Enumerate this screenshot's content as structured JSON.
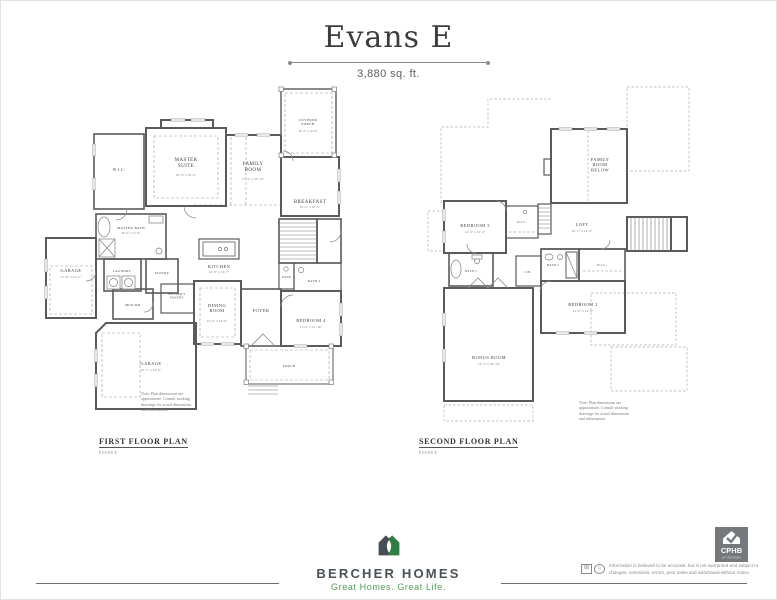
{
  "header": {
    "title": "Evans E",
    "subtitle": "3,880 sq. ft."
  },
  "first_floor": {
    "caption": "FIRST FLOOR PLAN",
    "caption_sub": "EVANS E",
    "note": "Note: Plan dimensions are approximate. Consult working drawings for actual dimensions and information.",
    "rooms": {
      "wic": {
        "name": "W.I.C."
      },
      "master_suite": {
        "name": "MASTER SUITE",
        "dims": "16'-4\" x 16'-0\""
      },
      "family_room": {
        "name": "FAMILY ROOM",
        "dims": "17'-4\" x 16'-10\""
      },
      "covered_porch": {
        "name": "COVERED PORCH",
        "dims": "16'-2\" x 10'-0\""
      },
      "breakfast": {
        "name": "BREAKFAST",
        "dims": "10'-2\" x 10'-0\""
      },
      "master_bath": {
        "name": "MASTER BATH",
        "dims": "16'-0\" x 12'-6\""
      },
      "garage_side": {
        "name": "GARAGE",
        "dims": "21'-8\" x 21'-2\""
      },
      "laundry": {
        "name": "LAUNDRY"
      },
      "pantry": {
        "name": "PANTRY"
      },
      "mud_rm": {
        "name": "MUD RM"
      },
      "butlers_pantry": {
        "name": "BUTLER'S PANTRY"
      },
      "kitchen": {
        "name": "KITCHEN",
        "dims": "12'-8\" x 13'-7\""
      },
      "dining_room": {
        "name": "DINING ROOM",
        "dims": "12'-0\" x 13'-0\""
      },
      "foyer": {
        "name": "FOYER"
      },
      "pwdr": {
        "name": "PWDR"
      },
      "bath4": {
        "name": "BATH 4"
      },
      "bedroom4": {
        "name": "BEDROOM 4",
        "dims": "11'-4\" x 12'-10\""
      },
      "garage_rear": {
        "name": "GARAGE",
        "dims": "22'-7\" x 24'-8\""
      },
      "porch": {
        "name": "PORCH"
      }
    }
  },
  "second_floor": {
    "caption": "SECOND FLOOR PLAN",
    "caption_sub": "EVANS E",
    "note": "Note: Plan dimensions are approximate. Consult working drawings for actual dimensions and information.",
    "rooms": {
      "family_room_below": {
        "name": "FAMILY ROOM BELOW"
      },
      "bedroom3": {
        "name": "BEDROOM 3",
        "dims": "12'-4\" x 12'-0\""
      },
      "wic3": {
        "name": "W.I.C."
      },
      "loft": {
        "name": "LOFT",
        "dims": "16'-7\" x 14'-4\""
      },
      "bath3": {
        "name": "BATH 3"
      },
      "lin": {
        "name": "LIN."
      },
      "bath2": {
        "name": "BATH 2"
      },
      "wic2": {
        "name": "W.I.C."
      },
      "bedroom2": {
        "name": "BEDROOM 2",
        "dims": "12'-0\" x 14'-2\""
      },
      "bonus_room": {
        "name": "BONUS ROOM",
        "dims": "12'-7\" x 20'-10\""
      }
    }
  },
  "footer": {
    "brand": "BERCHER HOMES",
    "tagline": "Great Homes. Great Life.",
    "disclaimer": "Information is believed to be accurate, but is not warranted and subject to changes, omissions, errors, prior sales and withdrawal without notice.",
    "badge_label": "CPHB",
    "badge_sub": "OF GEORGIA"
  },
  "colors": {
    "brand_green": "#2e7d41",
    "brand_gray": "#4a5256",
    "tagline_green": "#4f9d5c",
    "badge_gray": "#75797d",
    "drawing_line": "#5a5a5a"
  }
}
